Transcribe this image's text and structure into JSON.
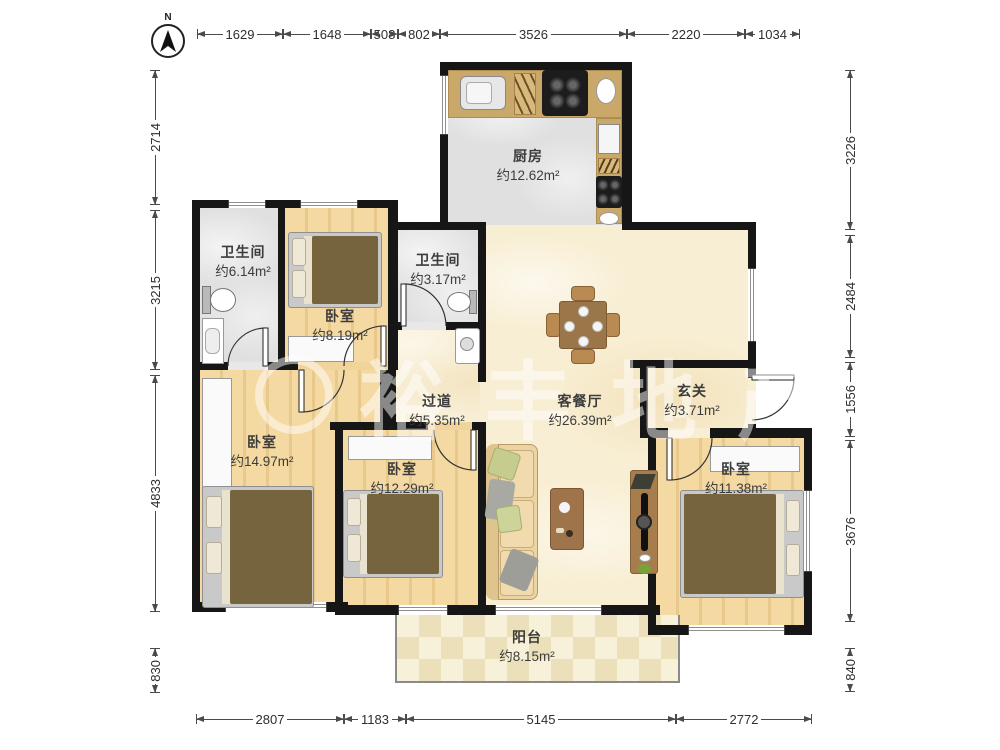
{
  "north": {
    "label": "N"
  },
  "watermark": {
    "text": "裕丰地产"
  },
  "dimensions": {
    "top": [
      "1629",
      "1648",
      "508",
      "802",
      "3526",
      "2220",
      "1034"
    ],
    "bottom": [
      "2807",
      "1183",
      "5145",
      "2772"
    ],
    "left": [
      "2714",
      "3215",
      "4833",
      "830"
    ],
    "right": [
      "3226",
      "2484",
      "1556",
      "3676",
      "840"
    ]
  },
  "rooms": {
    "kitchen": {
      "name": "厨房",
      "area": "约12.62m²"
    },
    "bathroom_main": {
      "name": "卫生间",
      "area": "约6.14m²"
    },
    "bedroom_top": {
      "name": "卧室",
      "area": "约8.19m²"
    },
    "bathroom_small": {
      "name": "卫生间",
      "area": "约3.17m²"
    },
    "hallway": {
      "name": "过道",
      "area": "约5.35m²"
    },
    "living_dining": {
      "name": "客餐厅",
      "area": "约26.39m²"
    },
    "entry": {
      "name": "玄关",
      "area": "约3.71m²"
    },
    "bedroom_left": {
      "name": "卧室",
      "area": "约14.97m²"
    },
    "bedroom_middle": {
      "name": "卧室",
      "area": "约12.29m²"
    },
    "bedroom_right": {
      "name": "卧室",
      "area": "约11.38m²"
    },
    "balcony": {
      "name": "阳台",
      "area": "约8.15m²"
    }
  },
  "colors": {
    "wall": "#161616",
    "wood_floor": "#f1d49c",
    "tile_floor": "#e0e0e0",
    "living_floor": "#f8eed3",
    "counter": "#c9a86a",
    "bed_blanket": "#76643f"
  }
}
